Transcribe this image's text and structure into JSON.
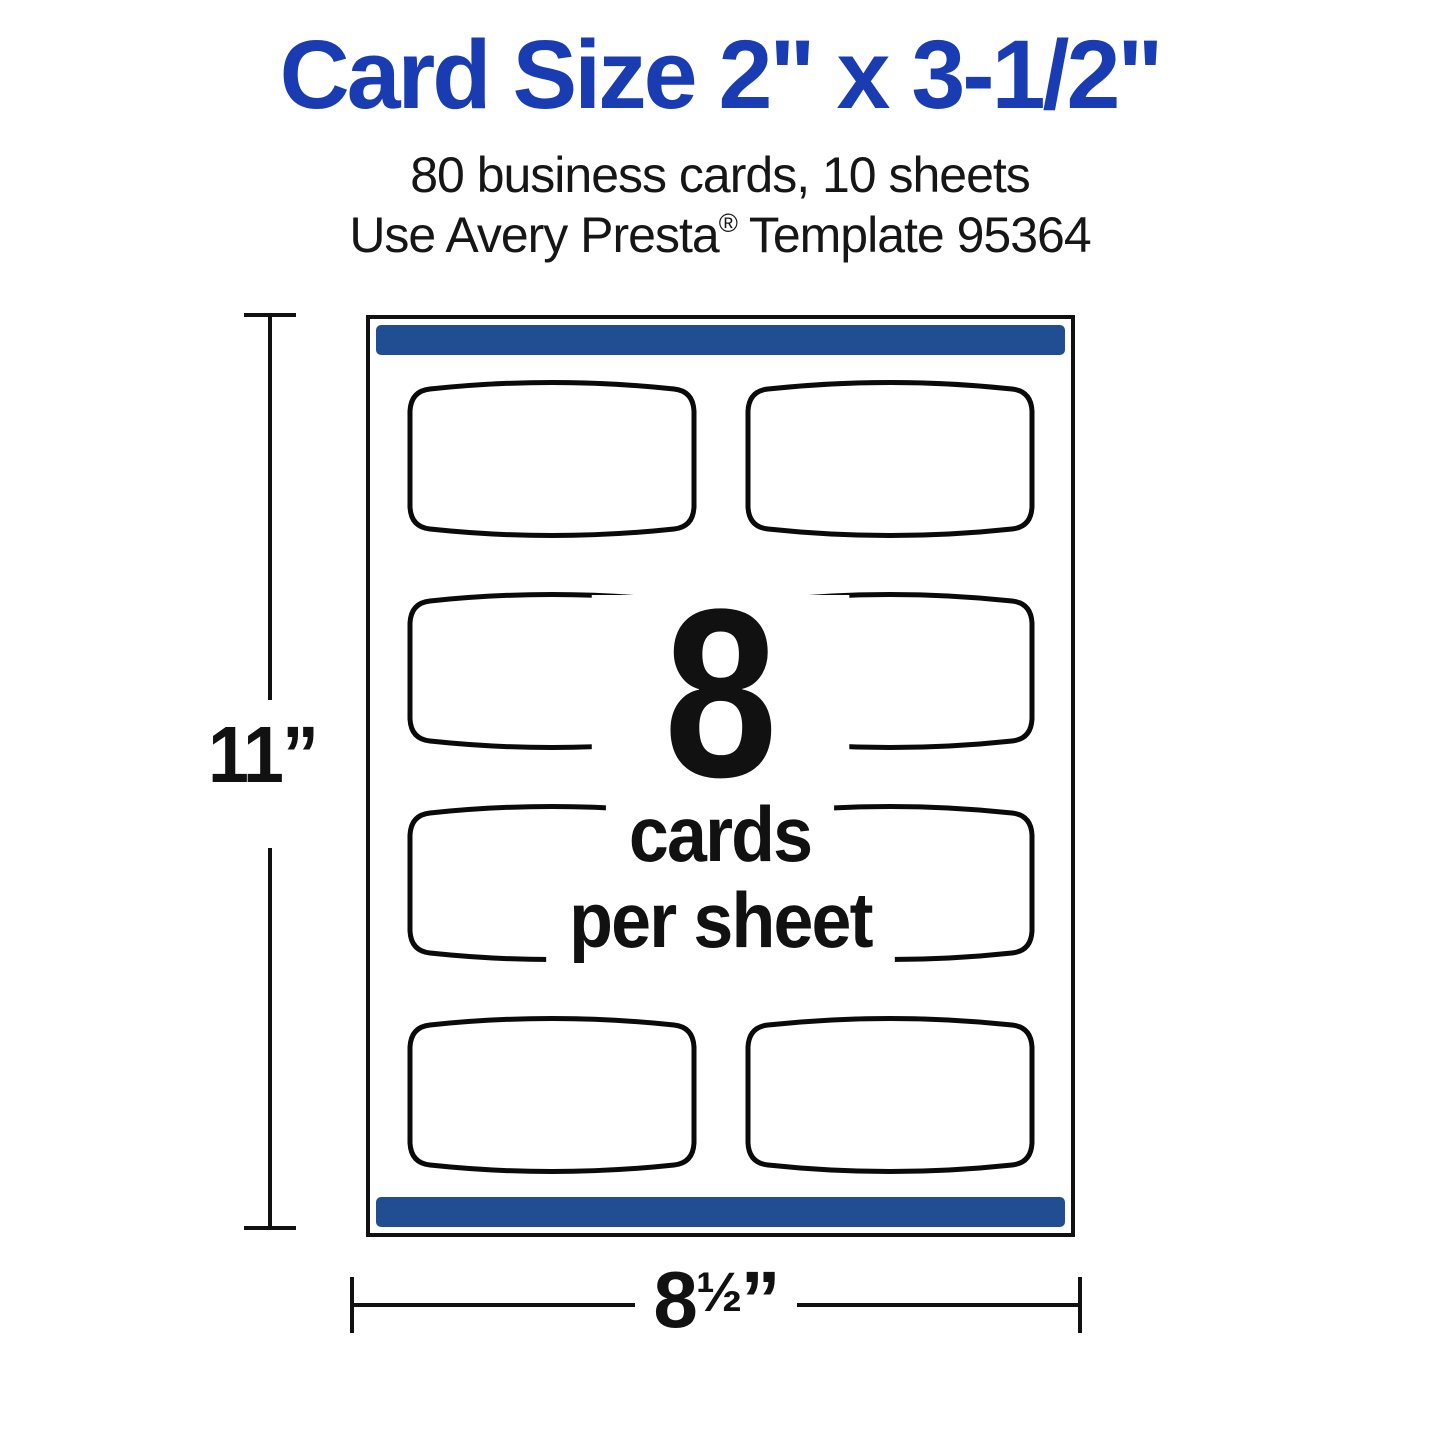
{
  "header": {
    "title": "Card Size 2\" x 3-1/2\"",
    "subtitle_line1": "80 business cards, 10 sheets",
    "subtitle_line2_prefix": "Use Avery Presta",
    "subtitle_line2_reg_mark": "®",
    "subtitle_line2_suffix": " Template 95364"
  },
  "sheet": {
    "rows": 4,
    "columns": 2,
    "cards_per_sheet": 8,
    "center_number": "8",
    "center_line1": "cards",
    "center_line2": "per sheet"
  },
  "dimensions": {
    "height_label": "11”",
    "width_label_number": "8",
    "width_label_fraction": "½",
    "width_label_unit": "”"
  },
  "colors": {
    "title_blue": "#1a3cb2",
    "bar_navy": "#214e92",
    "ink_black": "#111111"
  }
}
